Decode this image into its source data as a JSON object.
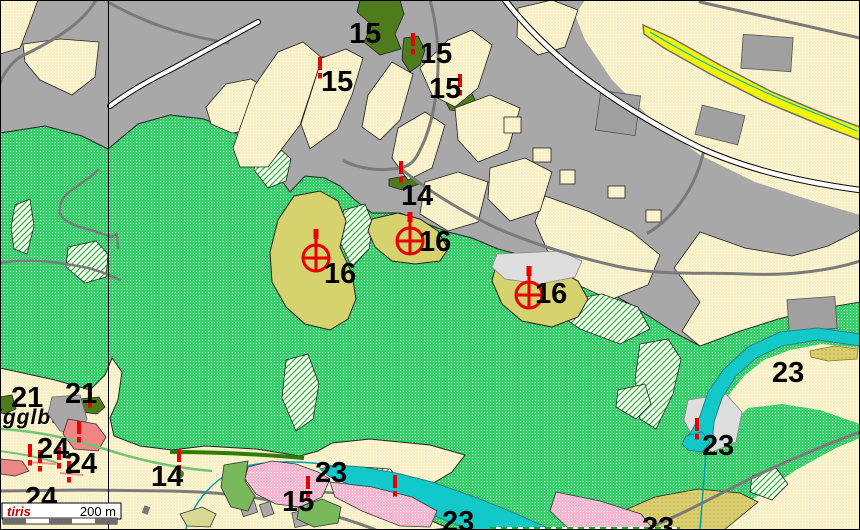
{
  "map": {
    "place_label": "igglberg",
    "logo_text": "tiris",
    "scale_text": "200 m",
    "labels": {
      "n15_a": "15",
      "n15_b": "15",
      "n15_c": "15",
      "n15_d": "15",
      "n15_e": "15",
      "n16_a": "16",
      "n16_b": "16",
      "n16_c": "16",
      "n14_a": "14",
      "n14_b": "14",
      "n21_a": "21",
      "n21_b": "21",
      "n23_a": "23",
      "n23_b": "23",
      "n23_c": "23",
      "n23_d": "23",
      "n23_e": "23",
      "n24_a": "24",
      "n24_b": "24",
      "n24_c": "24"
    },
    "colors": {
      "built_up_gray": "#a8a8a8",
      "parcel_cream": "#faf0c6",
      "meadow_green": "#34d169",
      "forest_dark_green": "#4e7c1d",
      "zone16_khaki": "#d6d26d",
      "water_cyan": "#12c9c9",
      "zone_pink": "#f7b6cf",
      "zone_salmon": "#ef8585",
      "grass_green": "#79b95c",
      "marker_red": "#e80000",
      "road_yellow": "#f4f400",
      "logo_red": "#c00000"
    }
  }
}
